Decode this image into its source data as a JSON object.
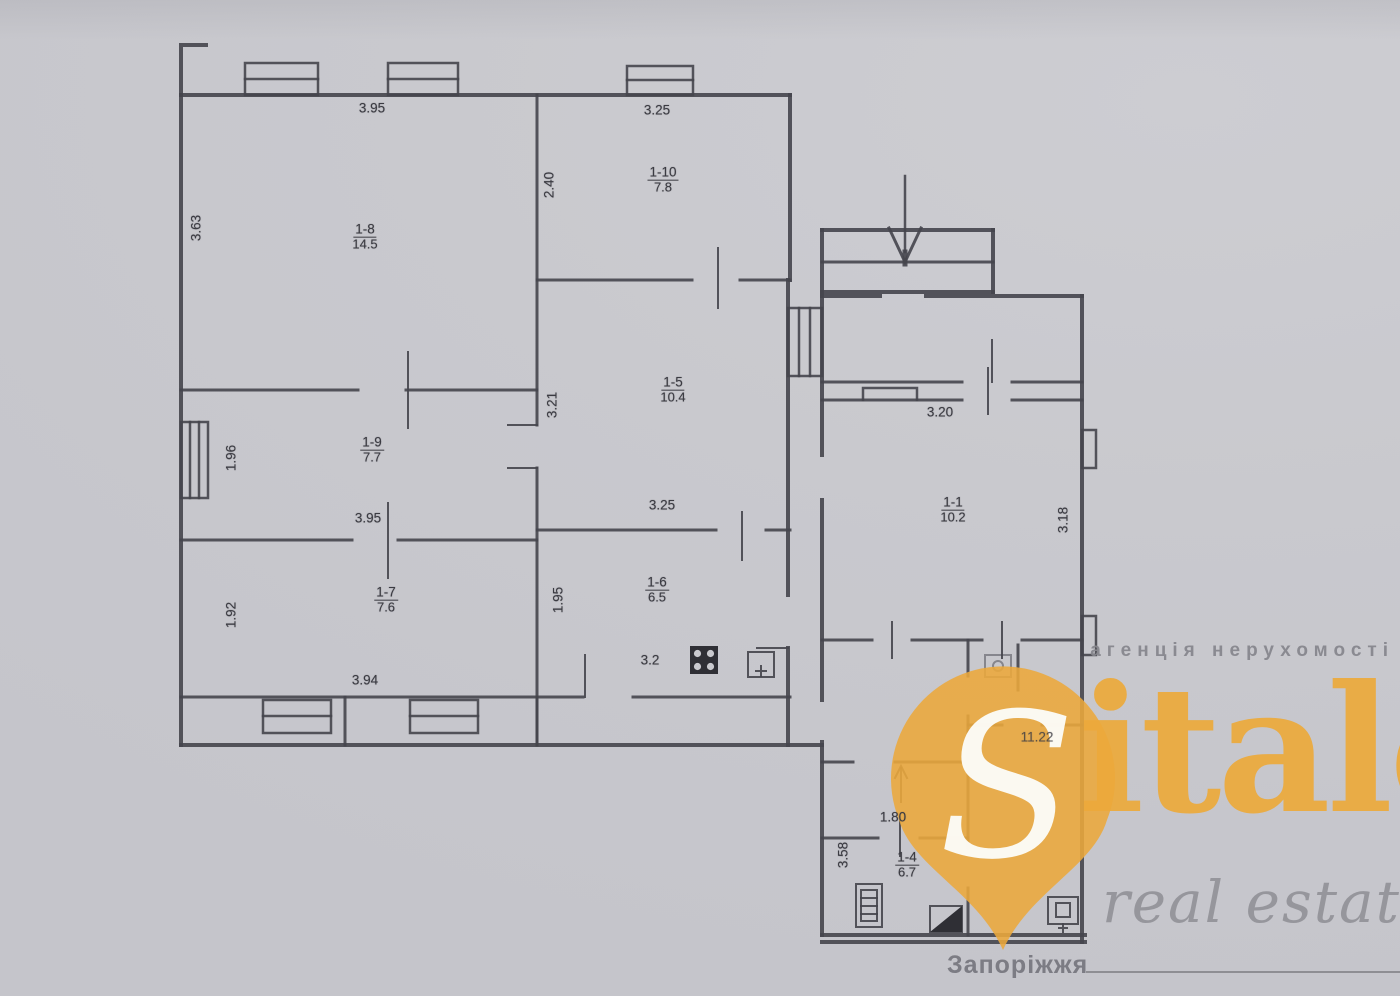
{
  "watermark": {
    "agency_line": "агенція нерухомості",
    "brand_initial": "S",
    "brand_suffix": "italo",
    "brand_sub": "real estate",
    "city": "Запоріжжя",
    "orange": "#ECA93B",
    "gray": "#87878D"
  },
  "plan": {
    "line_color": "#45454c",
    "fixtures": [
      "stove-icon",
      "sink-icon",
      "boiler-icon",
      "washing-machine-icon",
      "toilet-icon",
      "entrance-arrow-icon",
      "stairs-arrow-icon"
    ],
    "rooms": [
      {
        "id": "1-8",
        "area": "14.5",
        "x": 365,
        "y": 237
      },
      {
        "id": "1-9",
        "area": "7.7",
        "x": 372,
        "y": 450
      },
      {
        "id": "1-7",
        "area": "7.6",
        "x": 386,
        "y": 600
      },
      {
        "id": "1-10",
        "area": "7.8",
        "x": 663,
        "y": 180
      },
      {
        "id": "1-5",
        "area": "10.4",
        "x": 673,
        "y": 390
      },
      {
        "id": "1-6",
        "area": "6.5",
        "x": 657,
        "y": 590
      },
      {
        "id": "1-1",
        "area": "10.2",
        "x": 953,
        "y": 510
      },
      {
        "id": "1-4",
        "area": "6.7",
        "x": 907,
        "y": 865
      }
    ],
    "dimensions": [
      {
        "text": "3.95",
        "x": 372,
        "y": 108,
        "v": false
      },
      {
        "text": "3.25",
        "x": 657,
        "y": 110,
        "v": false
      },
      {
        "text": "3.63",
        "x": 196,
        "y": 228,
        "v": true
      },
      {
        "text": "2.40",
        "x": 549,
        "y": 185,
        "v": true
      },
      {
        "text": "3.21",
        "x": 552,
        "y": 405,
        "v": true
      },
      {
        "text": "3.25",
        "x": 662,
        "y": 505,
        "v": false
      },
      {
        "text": "1.96",
        "x": 231,
        "y": 458,
        "v": true
      },
      {
        "text": "3.95",
        "x": 368,
        "y": 518,
        "v": false
      },
      {
        "text": "1.92",
        "x": 231,
        "y": 615,
        "v": true
      },
      {
        "text": "3.94",
        "x": 365,
        "y": 680,
        "v": false
      },
      {
        "text": "1.95",
        "x": 558,
        "y": 600,
        "v": true
      },
      {
        "text": "3.2",
        "x": 650,
        "y": 660,
        "v": false
      },
      {
        "text": "3.20",
        "x": 940,
        "y": 412,
        "v": false
      },
      {
        "text": "3.18",
        "x": 1063,
        "y": 520,
        "v": true
      },
      {
        "text": "11.22",
        "x": 1037,
        "y": 737,
        "v": false,
        "faded": true
      },
      {
        "text": "1.80",
        "x": 893,
        "y": 817,
        "v": false
      },
      {
        "text": "3.58",
        "x": 843,
        "y": 855,
        "v": true
      }
    ]
  }
}
